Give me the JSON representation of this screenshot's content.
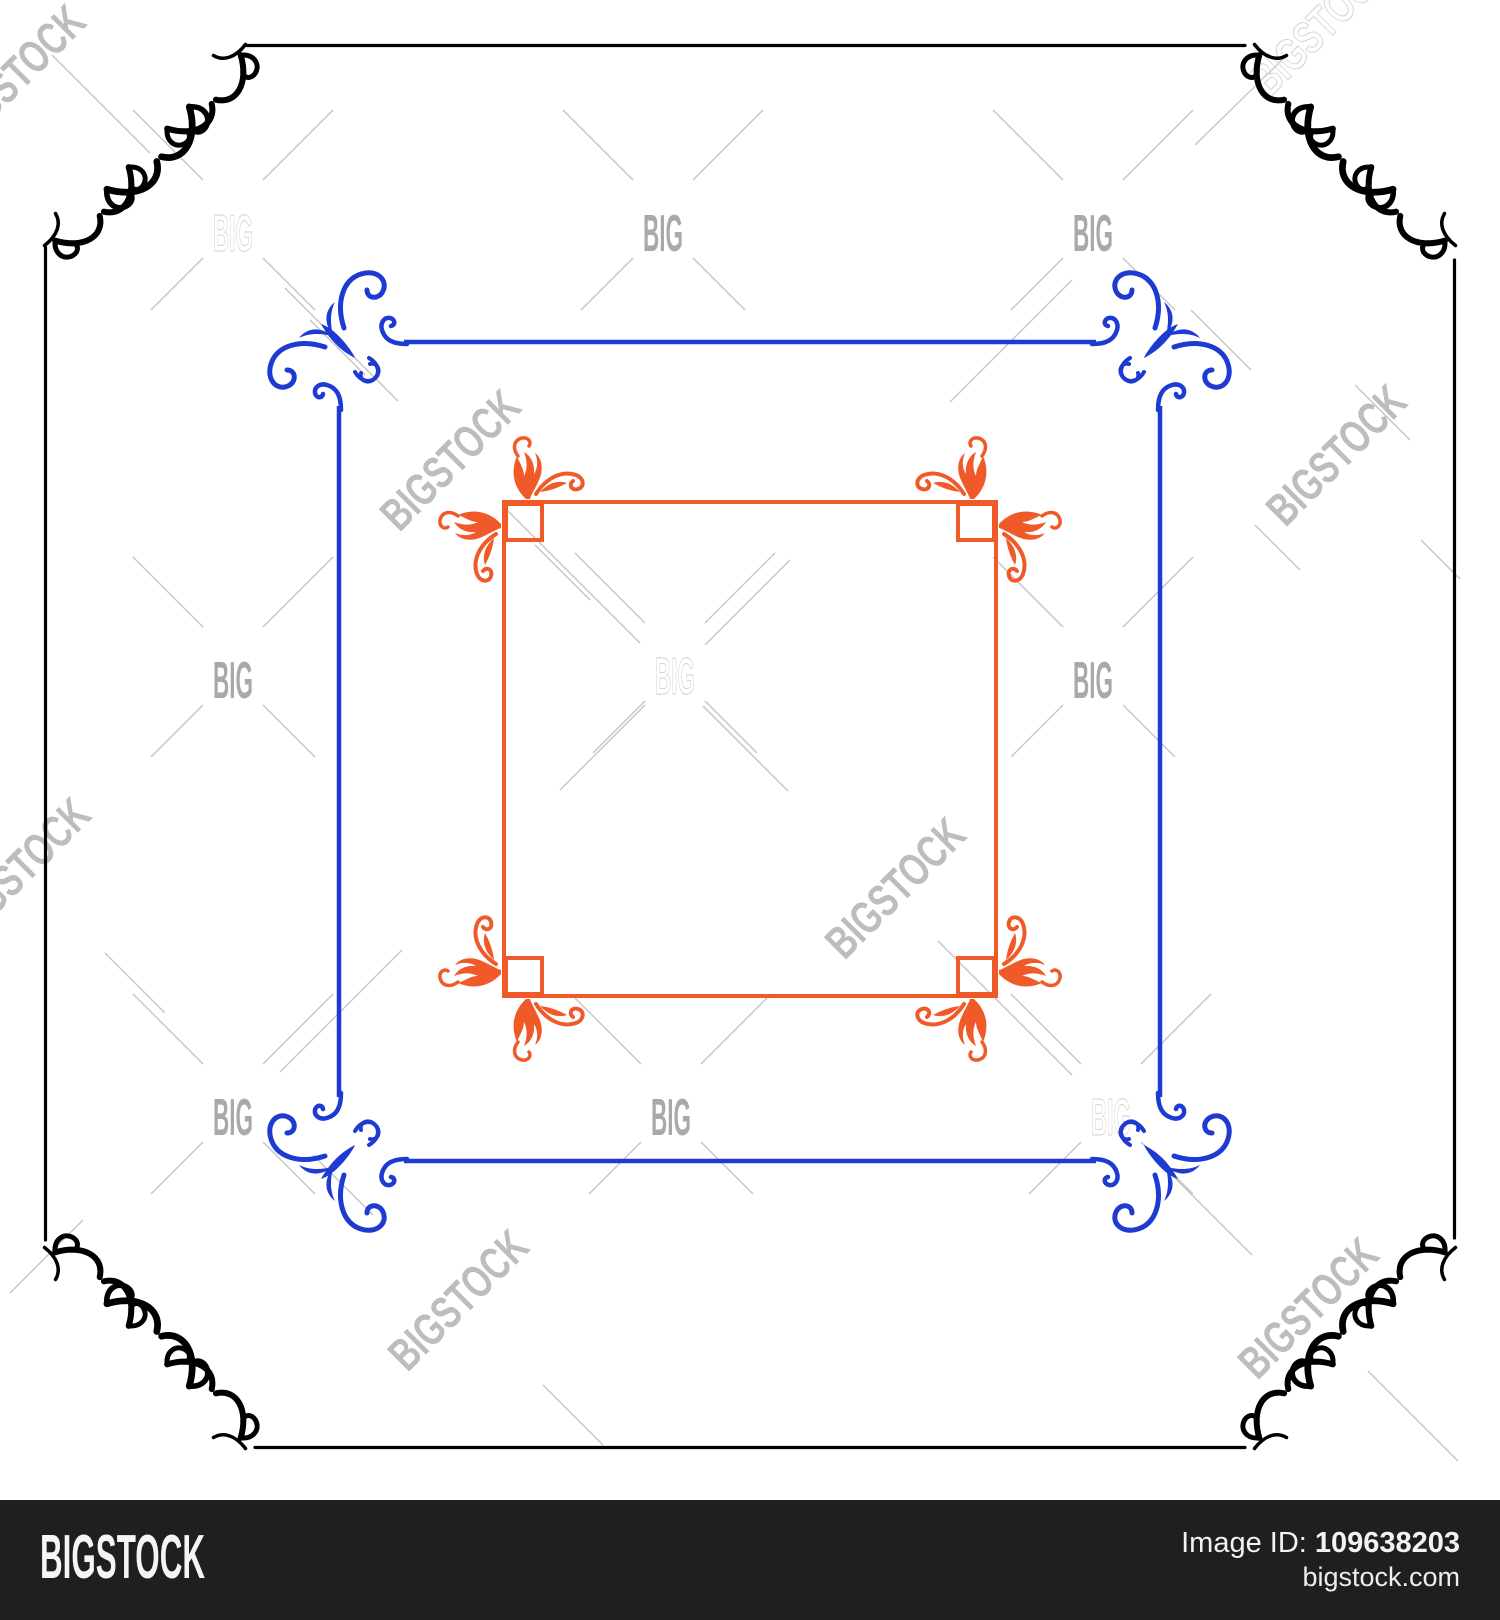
{
  "watermark": {
    "big_label": "BIG",
    "bigstock_label": "BIGSTOCK"
  },
  "footer": {
    "logo": "BIGSTOCK",
    "image_id_label": "Image ID:",
    "image_id_value": "109638203",
    "site": "bigstock.com"
  },
  "colors": {
    "outer_frame": "#000000",
    "middle_frame": "#1d3ad3",
    "inner_frame": "#f05a28",
    "footer_bg": "#1f1f1f",
    "footer_text": "#f5f5f5",
    "watermark_solid": "#a9a9a9",
    "watermark_light": "#bdbdbd",
    "watermark_outline": "#d8d8d8",
    "watermark_line": "#c6c6c6"
  }
}
